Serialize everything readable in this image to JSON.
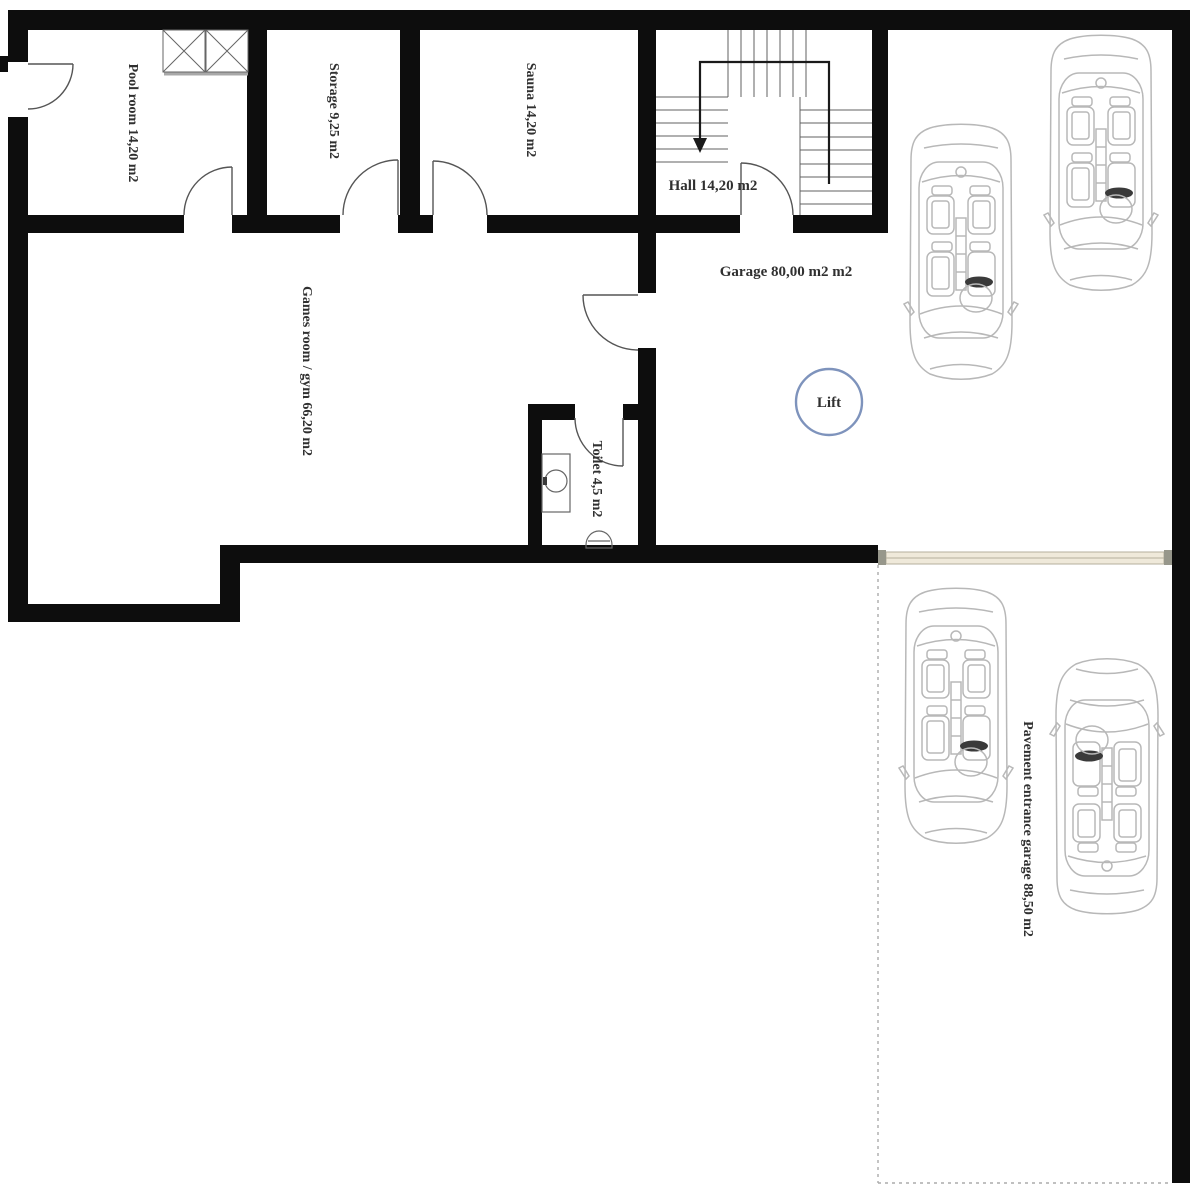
{
  "plan": {
    "rooms": [
      {
        "id": "pool-room",
        "label": "Pool room 14,20 m2"
      },
      {
        "id": "storage",
        "label": "Storage 9,25 m2"
      },
      {
        "id": "sauna",
        "label": "Sauna 14,20 m2"
      },
      {
        "id": "hall",
        "label": "Hall 14,20 m2"
      },
      {
        "id": "garage",
        "label": "Garage 80,00 m2 m2"
      },
      {
        "id": "games-room-gym",
        "label": "Games room / gym 66,20 m2"
      },
      {
        "id": "toilet",
        "label": "Toilet 4,5 m2"
      },
      {
        "id": "pavement-entrance-garage",
        "label": "Pavement entrance garage 88,50 m2"
      }
    ],
    "lift_label": "Lift",
    "icons": {
      "stairs_direction": "down-arrow",
      "shaft_symbol": "crossed-box",
      "lift_symbol": "circle-outline"
    },
    "colors": {
      "background": "#ffffff",
      "wall": "#0d0d0d",
      "label_text": "#303030",
      "door_line": "#555555",
      "stair_line": "#606060",
      "guide_line": "#1a1a1a",
      "car_outline": "#b8b8b8",
      "steering_fill": "#3a3a3a",
      "lift_ring": "#7e93bc",
      "garage_door_fill": "#efe9da",
      "garage_door_edge": "#b5af9c",
      "garage_door_cap": "#97978b",
      "dashed_line": "#ababab",
      "fixture_line": "#666666"
    }
  }
}
